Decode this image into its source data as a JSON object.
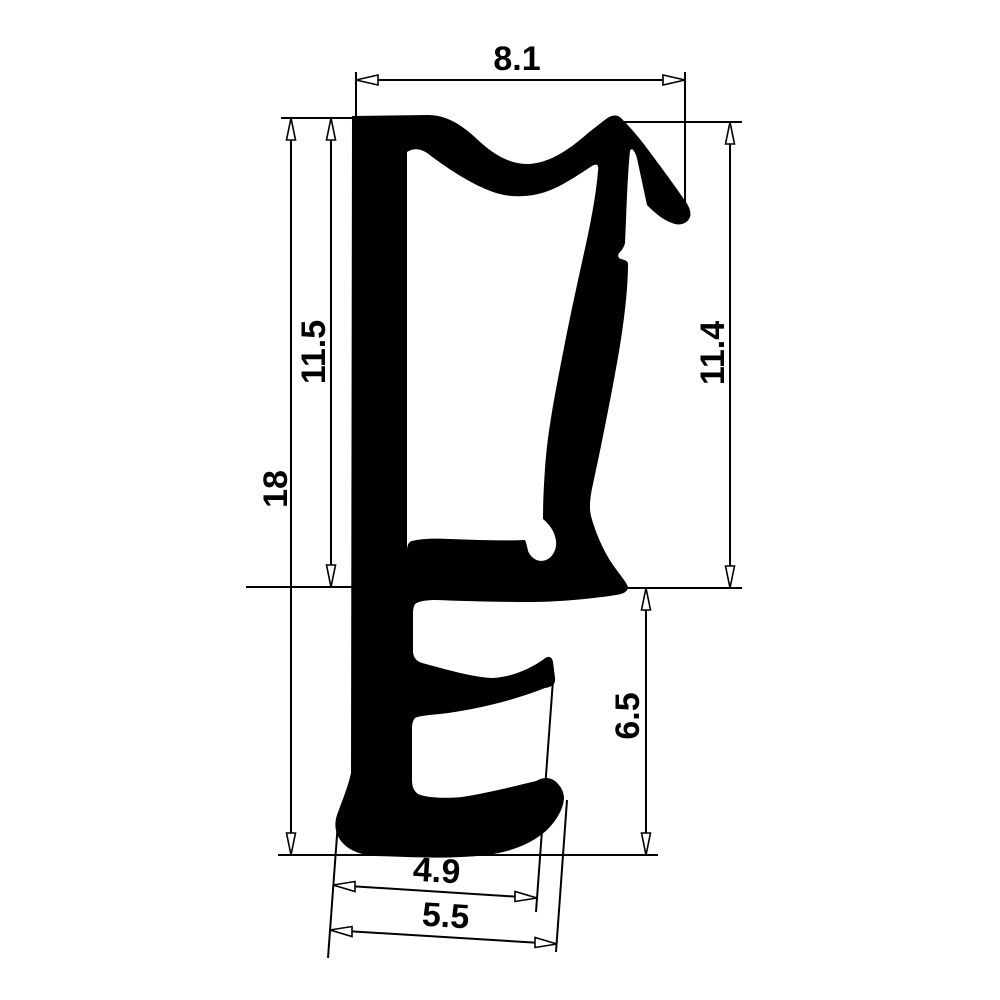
{
  "page": {
    "background": "#ffffff",
    "ink_color": "#000000"
  },
  "drawing": {
    "type": "technical-profile-cross-section",
    "subject": "rubber seal gasket profile silhouette",
    "dimensions": {
      "top_width": {
        "value": "8.1",
        "orientation": "horizontal"
      },
      "overall_height": {
        "value": "18",
        "orientation": "vertical"
      },
      "inner_height_left": {
        "value": "11.5",
        "orientation": "vertical"
      },
      "right_height": {
        "value": "11.4",
        "orientation": "vertical"
      },
      "lower_right_height": {
        "value": "6.5",
        "orientation": "vertical"
      },
      "bottom_inner_width": {
        "value": "4.9",
        "orientation": "slanted"
      },
      "bottom_outer_width": {
        "value": "5.5",
        "orientation": "slanted"
      }
    }
  }
}
